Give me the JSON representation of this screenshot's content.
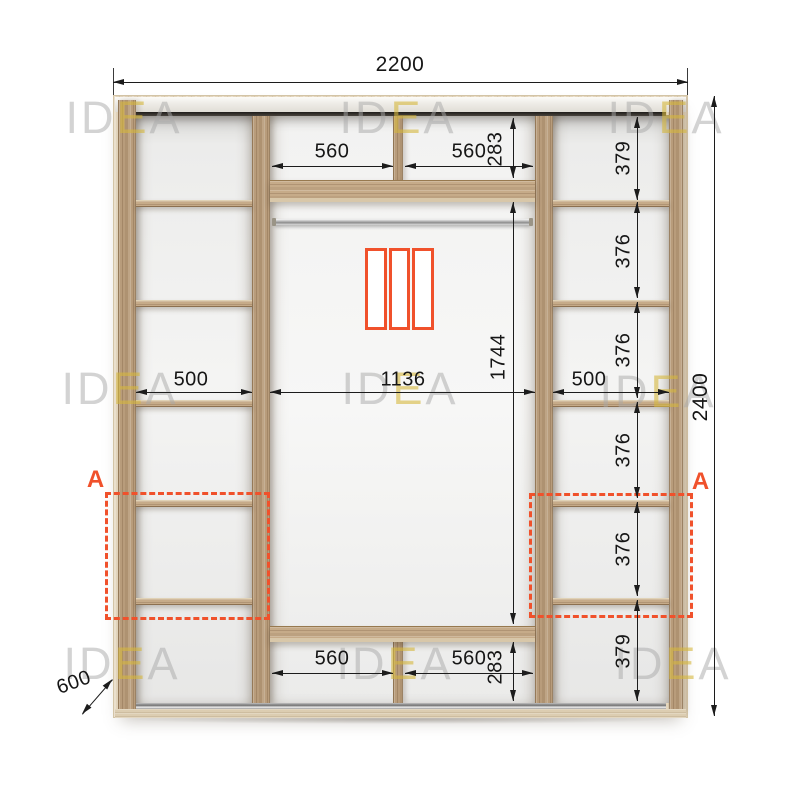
{
  "watermark": {
    "pre": "ID",
    "accent": "E",
    "post": "A"
  },
  "colors": {
    "accent_orange": "#F0512B",
    "wood_base": "#B89C7B",
    "frame_light": "#E4D6BD",
    "dim_line": "#1C1C1C"
  },
  "dims": {
    "overall_width": "2200",
    "overall_height": "2400",
    "depth": "600",
    "left_column_width": "500",
    "middle_width": "1136",
    "right_column_width": "500",
    "hang_zone_height": "1744",
    "top_row_height": "283",
    "bottom_row_height": "283",
    "top_cells": [
      "560",
      "560"
    ],
    "bottom_cells": [
      "560",
      "560"
    ],
    "right_cells": [
      "379",
      "376",
      "376",
      "376",
      "376",
      "379"
    ]
  },
  "markers": {
    "left": "A",
    "right": "A"
  },
  "door_icon": {
    "panels": 3
  }
}
